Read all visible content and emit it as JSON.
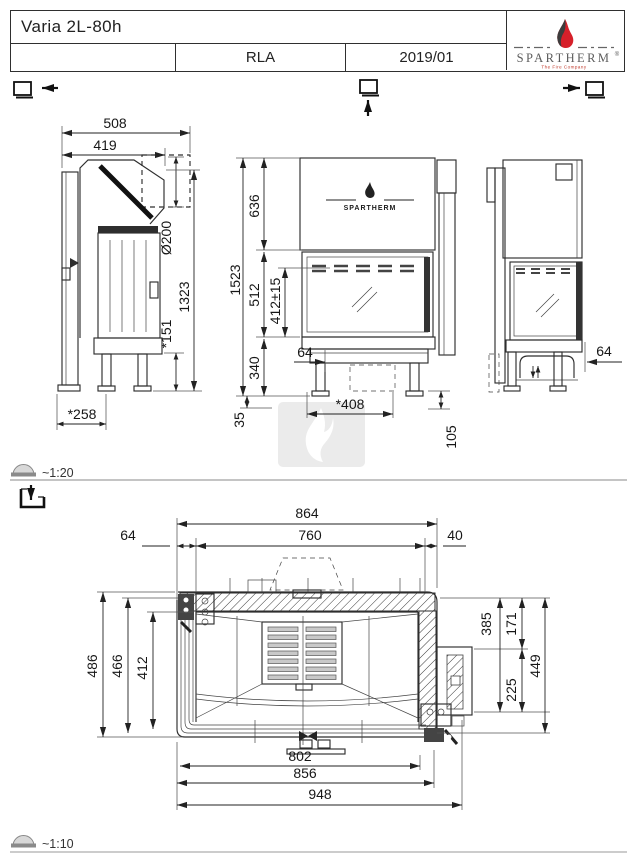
{
  "titleblock": {
    "model": "Varia 2L-80h",
    "revision": "RLA",
    "date": "2019/01",
    "brand": "SPARTHERM",
    "brand_reg": "®",
    "brand_tagline": "The Fire Company"
  },
  "icons": {
    "left_view_symbol": "square-arrow-left",
    "front_view_symbol": "square-arrow-up",
    "right_view_symbol": "arrow-right-square",
    "section_symbol": "section-arrow-down",
    "scale_symbol": "protractor"
  },
  "scales": {
    "upper": "~1:20",
    "lower": "~1:10"
  },
  "upper_drawing": {
    "front_logo": "SPARTHERM",
    "side_view_dims": {
      "d508": "508",
      "d419": "419",
      "d200": "Ø200",
      "d1323": "1323",
      "d151": "*151",
      "d258": "*258"
    },
    "front_view_dims": {
      "d1523": "1523",
      "d636": "636",
      "d512": "512",
      "d412": "412±15",
      "d340": "340",
      "d64": "64",
      "d35": "35",
      "d408": "*408",
      "d105": "105"
    },
    "right_view_dims": {
      "d64": "64"
    }
  },
  "plan_drawing": {
    "top_dims": {
      "d864": "864",
      "d760": "760",
      "d64": "64",
      "d40": "40"
    },
    "left_dims": {
      "d486": "486",
      "d466": "466",
      "d412": "412"
    },
    "right_dims": {
      "d385": "385",
      "d171": "171",
      "d225": "225",
      "d449": "449"
    },
    "bottom_dims": {
      "d802": "802",
      "d856": "856",
      "d948": "948"
    }
  },
  "colors": {
    "line": "#2e2e2e",
    "dim": "#222222",
    "flame_red": "#d6202a",
    "brand_gray": "#5c5c5c",
    "watermark": "#ebebeb"
  }
}
